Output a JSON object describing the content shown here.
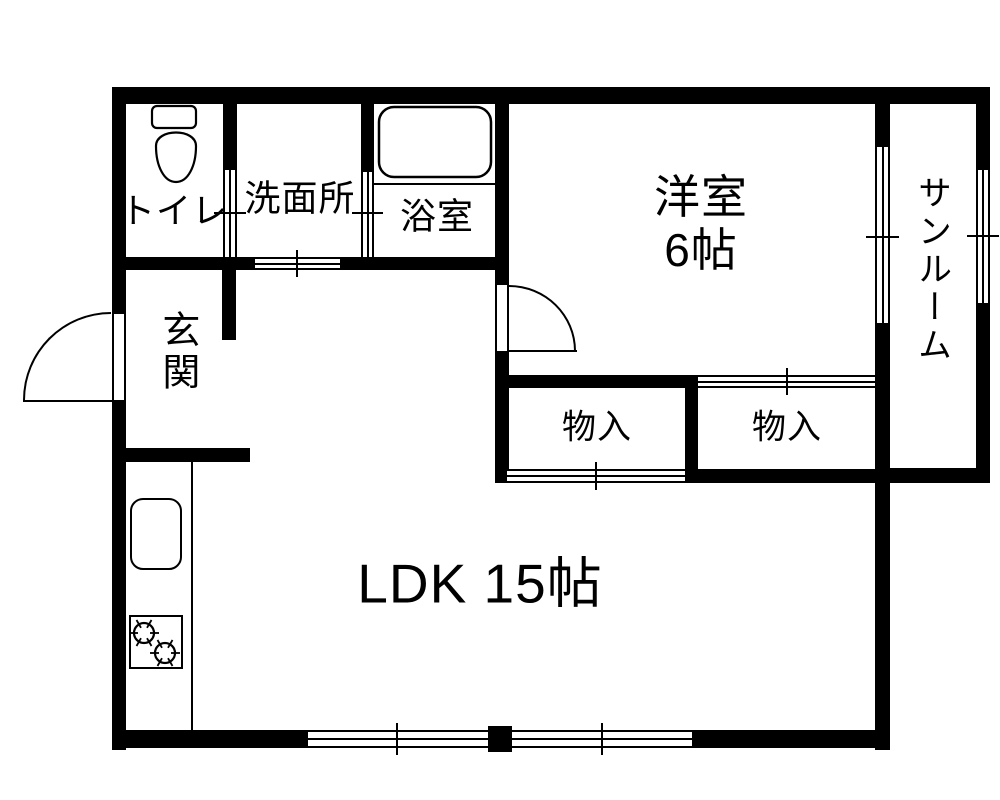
{
  "rooms": {
    "toilet": {
      "label": "トイレ"
    },
    "washroom": {
      "label": "洗面所"
    },
    "bathroom": {
      "label": "浴室"
    },
    "western_room": {
      "label": "洋室",
      "size": "6帖"
    },
    "sunroom": {
      "label": "サンルーム"
    },
    "entrance": {
      "label": "玄関"
    },
    "closet_left": {
      "label": "物入"
    },
    "closet_right": {
      "label": "物入"
    },
    "ldk": {
      "label": "LDK 15帖"
    }
  },
  "colors": {
    "wall": "#000000",
    "background": "#ffffff",
    "line": "#000000"
  }
}
